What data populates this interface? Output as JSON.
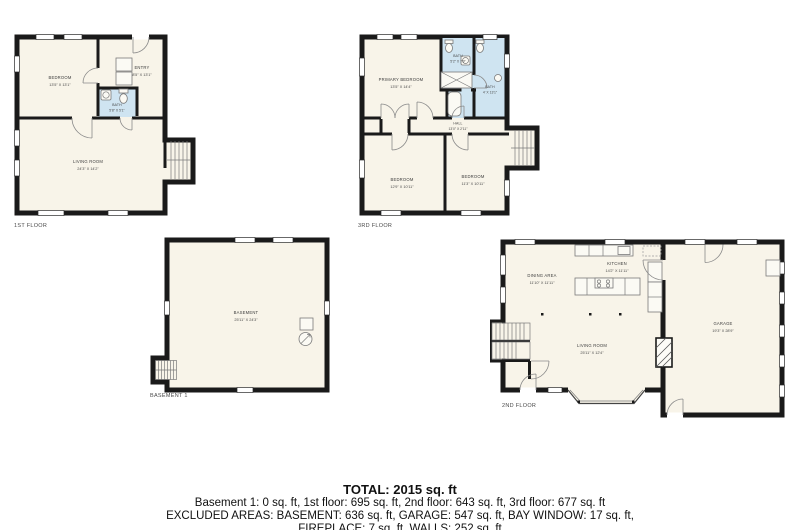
{
  "colors": {
    "wall": "#1a1a1a",
    "floor_fill": "#f8f4e9",
    "bath_fill": "#cfe4f1",
    "label_text": "#4a4a4a"
  },
  "plans": {
    "first": {
      "floor_label": "1ST FLOOR",
      "rooms": {
        "bedroom": {
          "name": "BEDROOM",
          "dims": "13'5\" X 13'1\""
        },
        "entry": {
          "name": "ENTRY",
          "dims": "8'5\" X 13'1\""
        },
        "bath": {
          "name": "BATH",
          "dims": "5'8\" X 5'1\""
        },
        "living": {
          "name": "LIVING ROOM",
          "dims": "24'3\" X 14'2\""
        }
      }
    },
    "third": {
      "floor_label": "3RD FLOOR",
      "rooms": {
        "primary": {
          "name": "PRIMARY BEDROOM",
          "dims": "13'5\" X 14'4\""
        },
        "bath_small": {
          "name": "BATH",
          "dims": "5'2\" X 7'9\""
        },
        "bath_large": {
          "name": "BATH",
          "dims": "4' X 13'1\""
        },
        "hall": {
          "name": "HALL",
          "dims": "13'0\" X 2'11\""
        },
        "bedroom_left": {
          "name": "BEDROOM",
          "dims": "12'9\" X 10'11\""
        },
        "bedroom_right": {
          "name": "BEDROOM",
          "dims": "11'3\" X 10'11\""
        }
      }
    },
    "basement": {
      "floor_label": "BASEMENT 1",
      "rooms": {
        "basement": {
          "name": "BASEMENT",
          "dims": "25'11\" X 24'3\""
        }
      }
    },
    "second": {
      "floor_label": "2ND FLOOR",
      "rooms": {
        "dining": {
          "name": "DINING AREA",
          "dims": "11'10\" X 11'11\""
        },
        "kitchen": {
          "name": "KITCHEN",
          "dims": "14'2\" X 11'11\""
        },
        "living": {
          "name": "LIVING ROOM",
          "dims": "25'11\" X 12'4\""
        },
        "garage": {
          "name": "GARAGE",
          "dims": "19'3\" X 28'9\""
        }
      }
    }
  },
  "summary": {
    "total": "TOTAL: 2015 sq. ft",
    "floors_line": "Basement 1: 0 sq. ft, 1st floor: 695 sq. ft, 2nd floor: 643 sq. ft, 3rd floor: 677 sq. ft",
    "excluded_line1": "EXCLUDED AREAS: BASEMENT: 636 sq. ft, GARAGE: 547 sq. ft, BAY WINDOW: 17 sq. ft,",
    "excluded_line2": "FIREPLACE: 7 sq. ft, WALLS: 252 sq. ft"
  }
}
